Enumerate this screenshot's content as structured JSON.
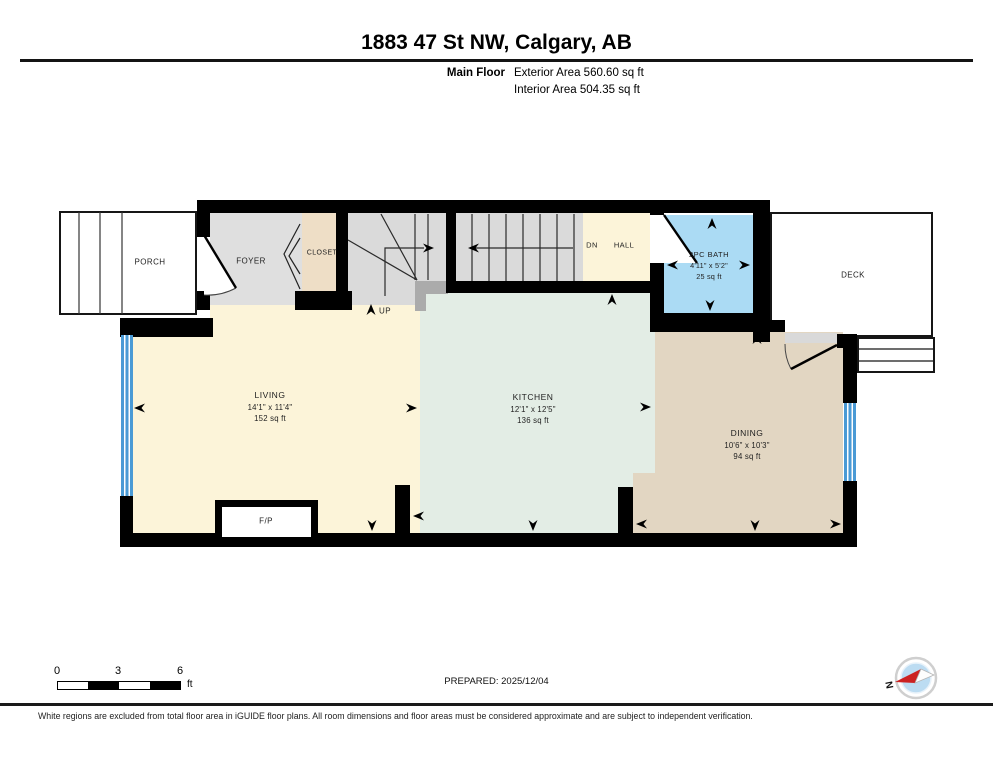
{
  "header": {
    "title": "1883 47 St NW, Calgary, AB",
    "floor_label": "Main Floor",
    "exterior_area": "Exterior Area 560.60 sq ft",
    "interior_area": "Interior Area 504.35 sq ft"
  },
  "rooms": {
    "porch": {
      "name": "PORCH"
    },
    "foyer": {
      "name": "FOYER"
    },
    "closet": {
      "name": "CLOSET"
    },
    "hall": {
      "name": "HALL",
      "stair_direction": "DN"
    },
    "stairs": {
      "up_label": "UP"
    },
    "bath": {
      "name": "2PC BATH",
      "dimensions": "4'11\" x 5'2\"",
      "area": "25 sq ft"
    },
    "deck": {
      "name": "DECK"
    },
    "living": {
      "name": "LIVING",
      "dimensions": "14'1\" x 11'4\"",
      "area": "152 sq ft"
    },
    "kitchen": {
      "name": "KITCHEN",
      "dimensions": "12'1\" x 12'5\"",
      "area": "136 sq ft"
    },
    "dining": {
      "name": "DINING",
      "dimensions": "10'6\" x 10'3\"",
      "area": "94 sq ft"
    },
    "fireplace": {
      "name": "F/P"
    }
  },
  "scale_bar": {
    "ticks": [
      "0",
      "3",
      "6"
    ],
    "unit": "ft"
  },
  "compass": {
    "north_label": "N"
  },
  "footer": {
    "prepared": "PREPARED: 2025/12/04",
    "disclaimer": "White regions are excluded from total floor area in iGUIDE floor plans. All room dimensions and floor areas must be considered approximate and are subject to independent verification."
  },
  "colors": {
    "wall": "#000000",
    "living": "#FCF4D9",
    "kitchen": "#E3EDE5",
    "dining": "#E2D6C2",
    "bath": "#ABDBF4",
    "closet": "#EEDEC6",
    "foyer": "#DFDFDF",
    "stairs": "#DADADA",
    "window": "#4A9AD5",
    "compass_needle": "#CC2222"
  }
}
